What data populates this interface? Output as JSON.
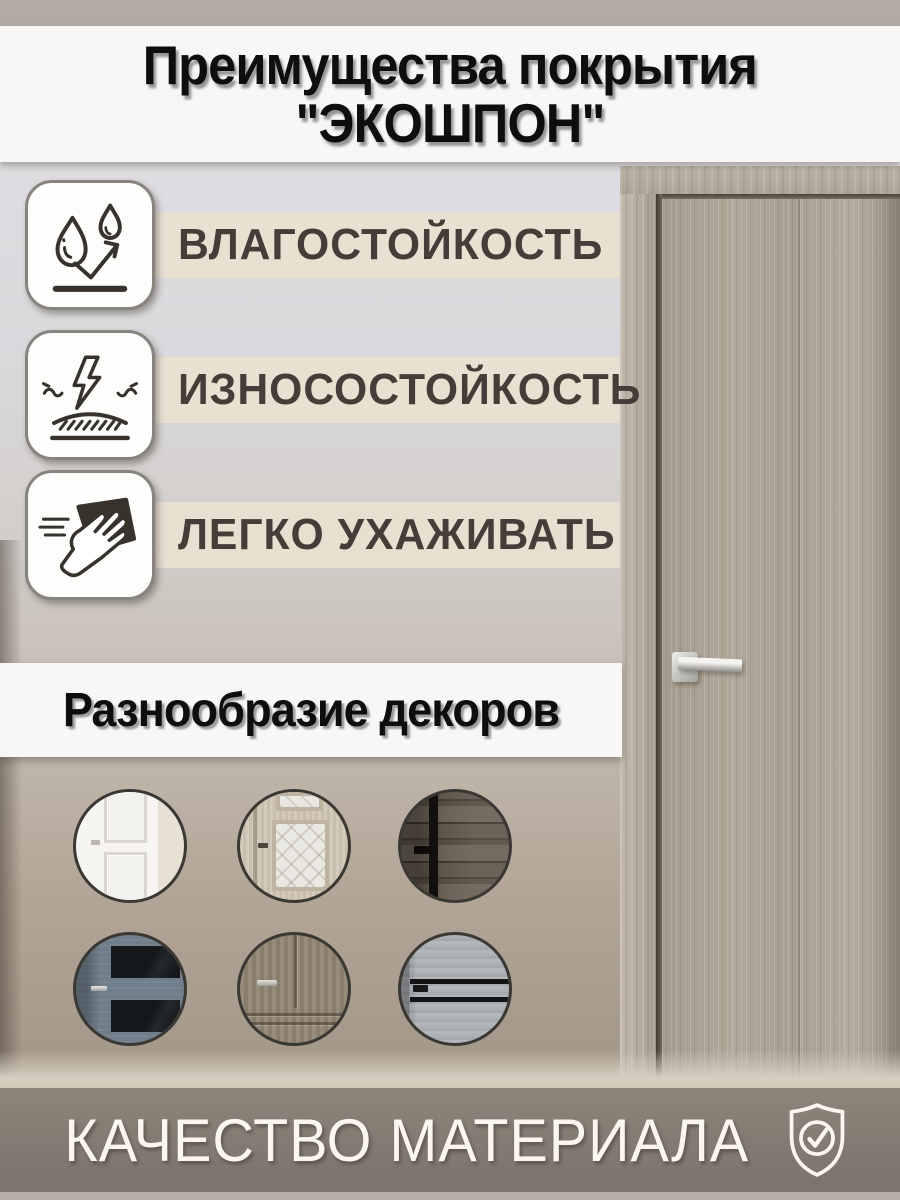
{
  "page": {
    "width": 900,
    "height": 1200,
    "kind": "marketplace-product-infographic"
  },
  "header": {
    "title_line1": "Преимущества покрытия",
    "title_line2": "\"ЭКОШПОН\""
  },
  "features": [
    {
      "icon": "water-drops-icon",
      "label": "ВЛАГОСТОЙКОСТЬ"
    },
    {
      "icon": "impact-lightning-icon",
      "label": "ИЗНОСОСТОЙКОСТЬ"
    },
    {
      "icon": "hand-wipe-icon",
      "label": "ЛЕГКО УХАЖИВАТЬ"
    }
  ],
  "decor_section": {
    "title": "Разнообразие декоров",
    "decors": [
      "white-classic-door",
      "cream-etched-glass-door",
      "dark-rustic-wood-door",
      "blue-gray-dark-glass-door",
      "gray-walnut-classic-door",
      "light-gray-plank-door"
    ]
  },
  "footer": {
    "label": "КАЧЕСТВО МАТЕРИАЛА",
    "icon": "shield-check-icon"
  },
  "photo": {
    "subject": "gray-oak-interior-door",
    "handle": "chrome-square-lever"
  },
  "colors": {
    "accent_strip": "#e9e0d1",
    "title_banner": "#f8f7f5",
    "footer_banner": "#827970",
    "footer_text": "#fbf6ee",
    "icon_stroke": "#37322c",
    "label_text": "#453e38",
    "door_wood": "#a79e92",
    "circle_border": "#3b3834"
  }
}
